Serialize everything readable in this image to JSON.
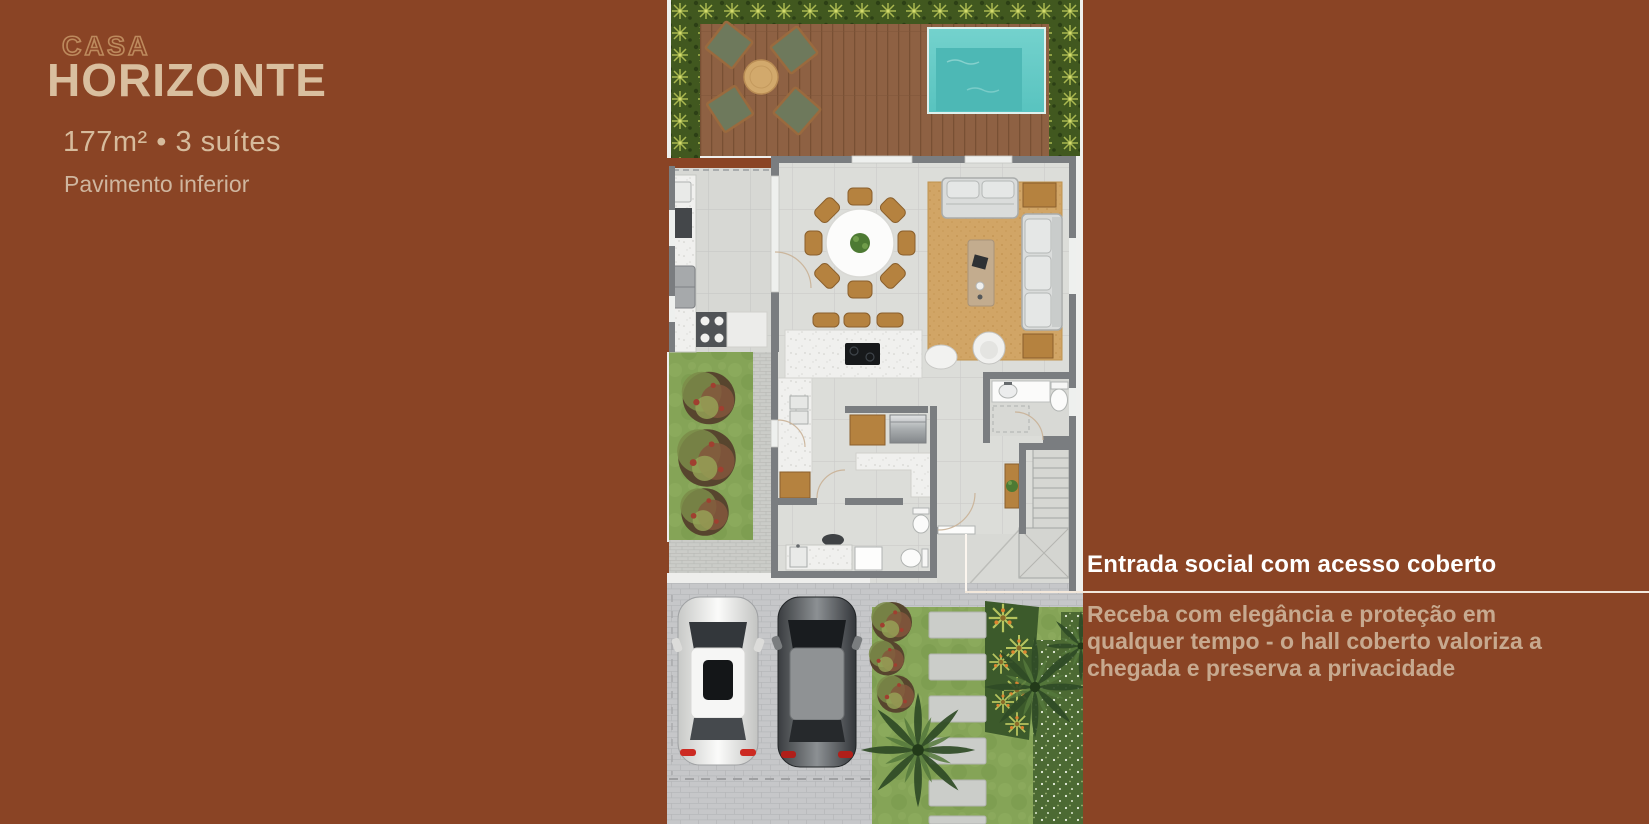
{
  "page": {
    "width": 1649,
    "height": 824,
    "background": "#8a4425"
  },
  "left_panel": {
    "kicker": "CASA",
    "title": "HORIZONTE",
    "specs": "177m² • 3 suítes",
    "floor_label": "Pavimento inferior"
  },
  "callout": {
    "heading": "Entrada social com acesso coberto",
    "body": "Receba com elegância e proteção em qualquer tempo - o hall coberto valoriza a chegada e preserva a privacidade"
  },
  "floorplan": {
    "areas": [
      "hedge",
      "wood-deck",
      "outdoor-lounge",
      "pool",
      "kitchen",
      "dining-room",
      "living-room",
      "island",
      "laundry",
      "bathroom",
      "powder-room",
      "stairs",
      "hall",
      "entry-porch",
      "side-garden",
      "driveway",
      "parked-cars",
      "front-lawn",
      "stepping-stones",
      "palm-trees"
    ]
  },
  "colors": {
    "background": "#8a4425",
    "title_tan": "#d9bf9f",
    "kicker_outline": "#bd8a5d",
    "specs_tan": "#d6bb9c",
    "floor_label_tan": "#cfb69f",
    "heading_white": "#ffffff",
    "body_tan": "#c7a98f",
    "callout_line": "#f3e8db",
    "pool_teal": "#5ec7c3",
    "deck_wood": "#8e6143",
    "furniture_wood": "#b5823f",
    "rug_tan": "#d1a566",
    "floor_gray": "#dcddd9",
    "wall_gray": "#7a7d80",
    "grass_green": "#85a457",
    "driveway_gray": "#c6c7c9"
  }
}
